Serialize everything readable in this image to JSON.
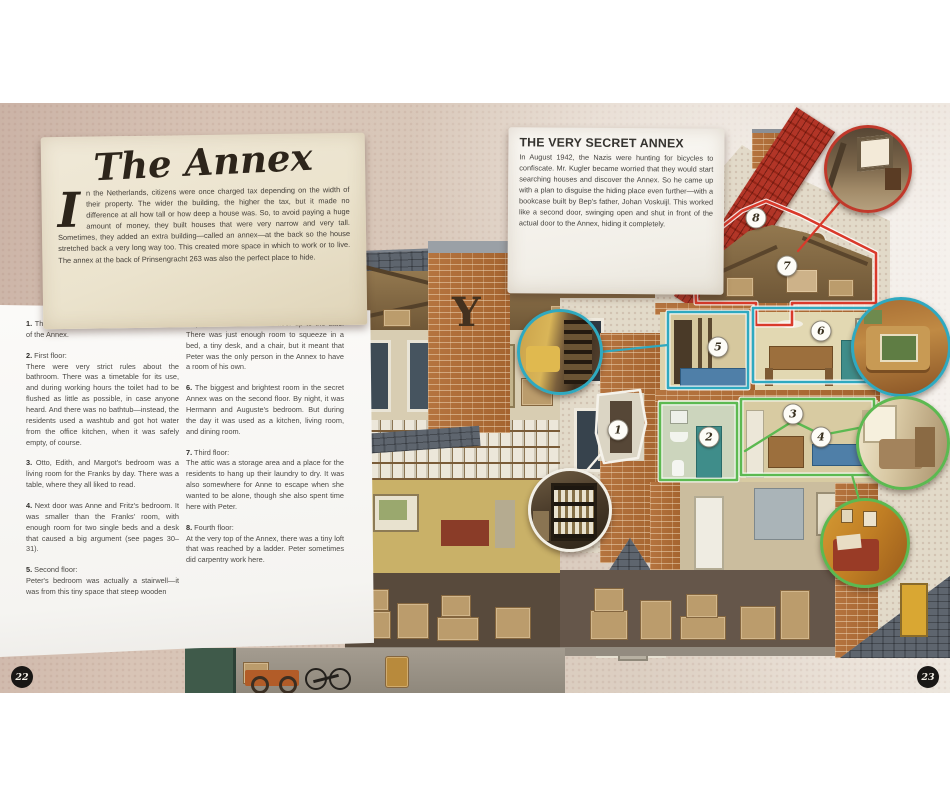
{
  "page": {
    "left_number": "22",
    "right_number": "23"
  },
  "intro": {
    "title": "The Annex",
    "drop_cap": "I",
    "body": "n the Netherlands, citizens were once charged tax depending on the width of their property. The wider the building, the higher the tax, but it made no difference at all how tall or how deep a house was. So, to avoid paying a huge amount of money, they built houses that were very narrow and very tall. Sometimes, they added an extra building—called an annex—at the back so the house stretched back a very long way too. This created more space in which to work or to live. The annex at the back of Prinsengracht 263 was also the perfect place to hide."
  },
  "secret_box": {
    "title": "THE VERY SECRET ANNEX",
    "body": "In August 1942, the Nazis were hunting for bicycles to confiscate. Mr. Kugler became worried that they would start searching houses and discover the Annex. So he came up with a plan to disguise the hiding place even further—with a bookcase built by Bep's father, Johan Voskuijl. This worked like a second door, swinging open and shut in front of the actual door to the Annex, hiding it completely."
  },
  "notes_col1": [
    {
      "num": "1.",
      "body": "The swinging bookcase leading to the door of the Annex."
    },
    {
      "num": "2.",
      "lead": "First floor:",
      "body": "There were very strict rules about the bathroom. There was a timetable for its use, and during working hours the toilet had to be flushed as little as possible, in case anyone heard. And there was no bathtub—instead, the residents used a washtub and got hot water from the office kitchen, when it was safely empty, of course."
    },
    {
      "num": "3.",
      "body": "Otto, Edith, and Margot's bedroom was a living room for the Franks by day. There was a table, where they all liked to read."
    },
    {
      "num": "4.",
      "body": "Next door was Anne and Fritz's bedroom. It was smaller than the Franks' room, with enough room for two single beds and a desk that caused a big argument (see pages 30–31)."
    },
    {
      "num": "5.",
      "lead": "Second floor:",
      "body": "Peter's bedroom was actually a stairwell—it was from this tiny space that steep wooden"
    }
  ],
  "notes_col2": [
    {
      "body": "steps led from the second floor up to the attic. There was just enough room to squeeze in a bed, a tiny desk, and a chair, but it meant that Peter was the only person in the Annex to have a room of his own."
    },
    {
      "num": "6.",
      "body": "The biggest and brightest room in the secret Annex was on the second floor. By night, it was Hermann and Auguste's bedroom. But during the day it was used as a kitchen, living room, and dining room."
    },
    {
      "num": "7.",
      "lead": "Third floor:",
      "body": "The attic was a storage area and a place for the residents to hang up their laundry to dry. It was also somewhere for Anne to escape when she wanted to be alone, though she also spent time here with Peter."
    },
    {
      "num": "8.",
      "lead": "Fourth floor:",
      "body": "At the very top of the Annex, there was a tiny loft that was reached by a ladder. Peter sometimes did carpentry work here."
    }
  ],
  "markers": {
    "m1": "1",
    "m2": "2",
    "m3": "3",
    "m4": "4",
    "m5": "5",
    "m6": "6",
    "m7": "7",
    "m8": "8"
  },
  "colors": {
    "attic_outline": "#d93a2b",
    "second_floor_outline": "#2fa9c0",
    "first_floor_outline": "#5cb951",
    "bookcase_outline": "#f5f2ea",
    "badge_background": "#191715"
  }
}
